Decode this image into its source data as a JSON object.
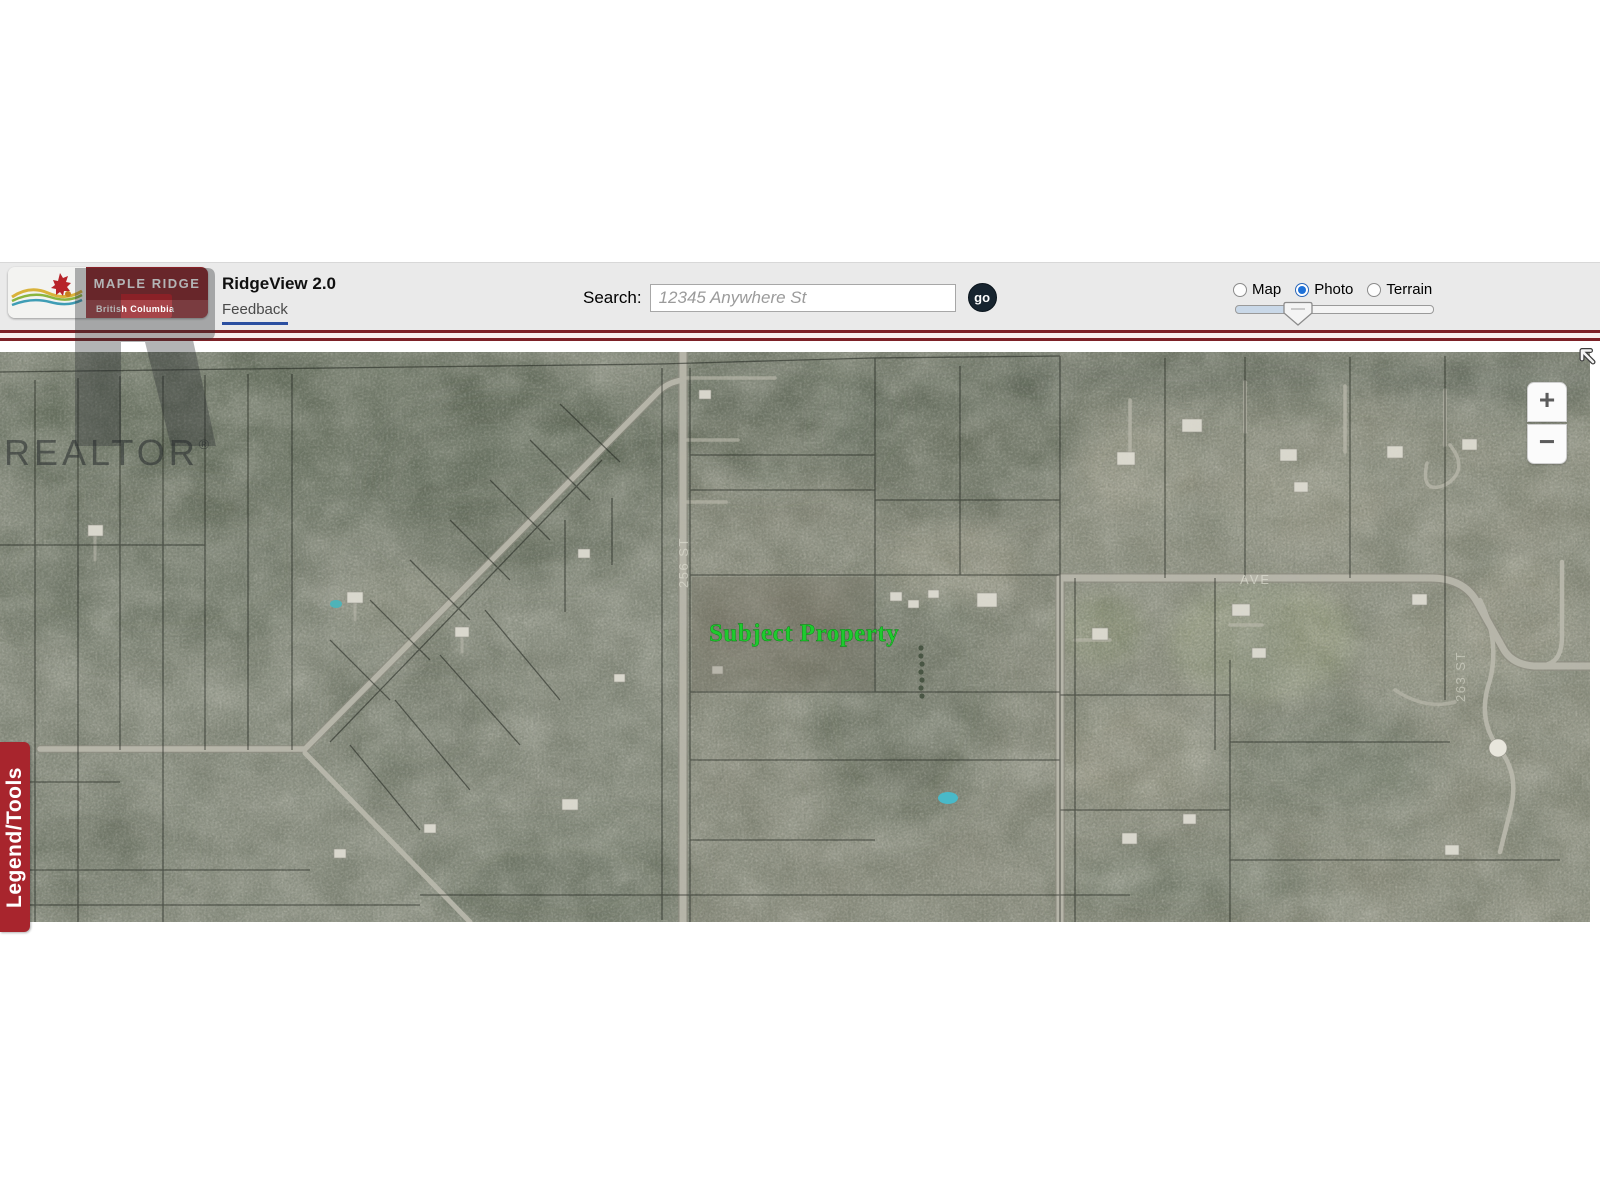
{
  "header": {
    "logo": {
      "line1": "MAPLE RIDGE",
      "line2": "British Columbia"
    },
    "app_title": "RidgeView 2.0",
    "feedback": "Feedback",
    "search_label": "Search:",
    "search_placeholder": "12345 Anywhere St",
    "go": "go",
    "layers": [
      {
        "label": "Map",
        "selected": false
      },
      {
        "label": "Photo",
        "selected": true
      },
      {
        "label": "Terrain",
        "selected": false
      }
    ]
  },
  "map": {
    "subject_property_label": "Subject Property",
    "road_labels": [
      {
        "text": "256 ST"
      },
      {
        "text": "263 ST"
      },
      {
        "text": "AVE"
      }
    ],
    "legend_tab": "Legend/Tools",
    "controls": {
      "zoom_in": "+",
      "zoom_out": "−"
    }
  },
  "watermark": {
    "text": "REALTOR",
    "reg": "®"
  },
  "colors": {
    "header_rule_red": "#7c2127",
    "tab_red": "#a8252d",
    "logo_red": "#8a2127",
    "radio_selected_blue": "#1e71d8",
    "subject_green": "#1ecb2e",
    "go_button": "#17242f",
    "feedback_underline": "#2b4fa0"
  }
}
